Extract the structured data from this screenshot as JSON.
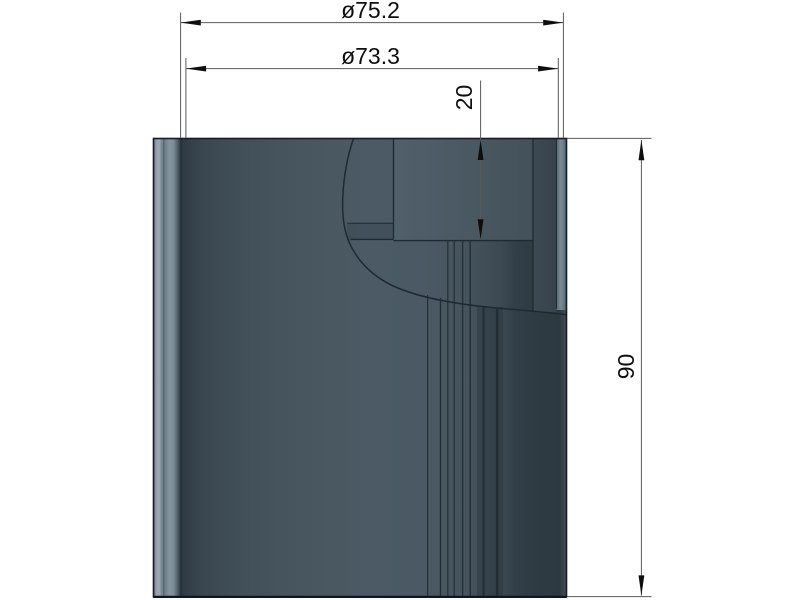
{
  "drawing": {
    "kind": "cad-3d-shaded-view-with-dimensions",
    "part": "stepped-cylinder",
    "background": "#ffffff"
  },
  "dimensions": {
    "dia752": {
      "label": "ø75.2",
      "orientation": "horizontal"
    },
    "dia733": {
      "label": "ø73.3",
      "orientation": "horizontal"
    },
    "depth20": {
      "label": "20",
      "orientation": "vertical"
    },
    "height90": {
      "label": "90",
      "orientation": "vertical"
    }
  },
  "colors": {
    "body_mid": "#4a5963",
    "body_dark": "#2e3a42",
    "body_highlight": "#9aa9b2",
    "body_light_band": "#7b8b94",
    "edge_line": "#141d25",
    "dimension_line": "#595959",
    "arrow_and_text": "#0e0e0e",
    "background": "#ffffff"
  }
}
